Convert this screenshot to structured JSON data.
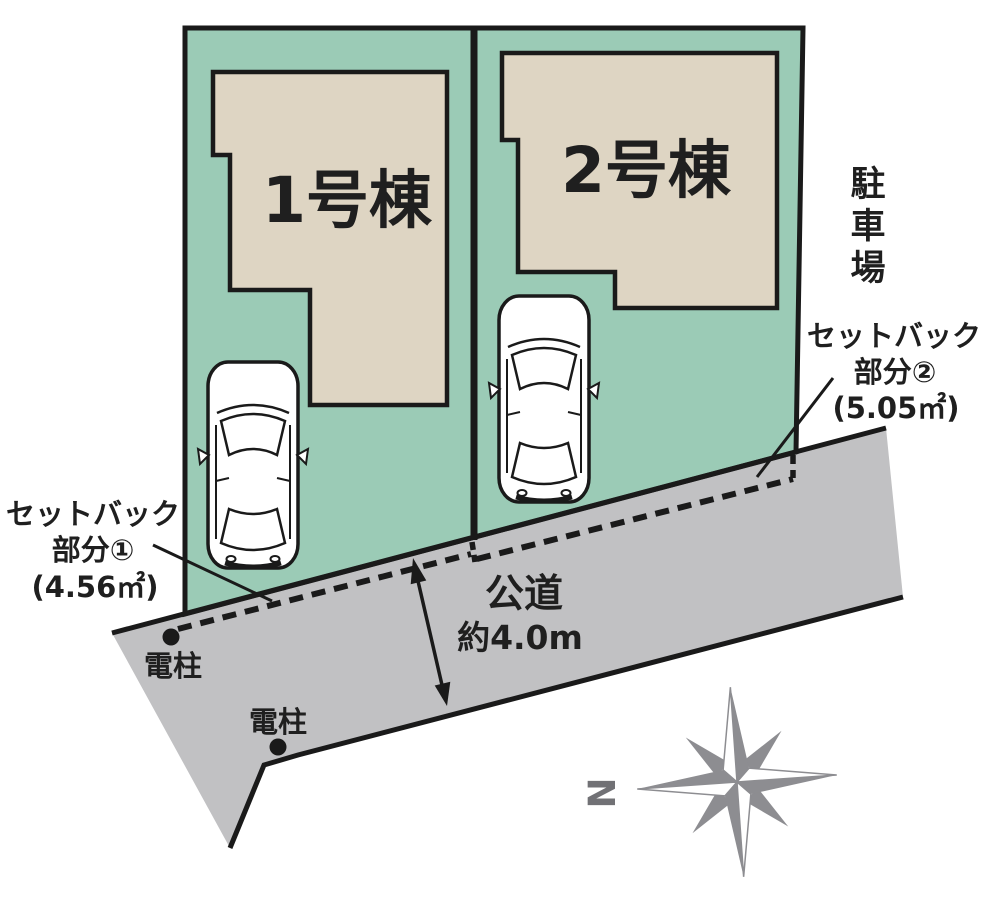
{
  "site_plan": {
    "buildings": [
      {
        "label": "1号棟"
      },
      {
        "label": "2号棟"
      }
    ],
    "parking": {
      "label": "駐車場",
      "chars": [
        "駐",
        "車",
        "場"
      ]
    },
    "road": {
      "name": "公道",
      "width_note": "約4.0m"
    },
    "setbacks": [
      {
        "l1": "セットバック",
        "l2": "部分①",
        "l3": "(4.56㎡)"
      },
      {
        "l1": "セットバック",
        "l2": "部分②",
        "l3": "(5.05㎡)"
      }
    ],
    "poles": [
      {
        "label": "電柱"
      },
      {
        "label": "電柱"
      }
    ],
    "compass": {
      "north": "N"
    },
    "colors": {
      "lot_green": "#9bcbb6",
      "building_beige": "#ded5c3",
      "road_gray": "#c1c1c3",
      "outline_black": "#1a1a1a",
      "compass_gray": "#8d8d91"
    }
  }
}
